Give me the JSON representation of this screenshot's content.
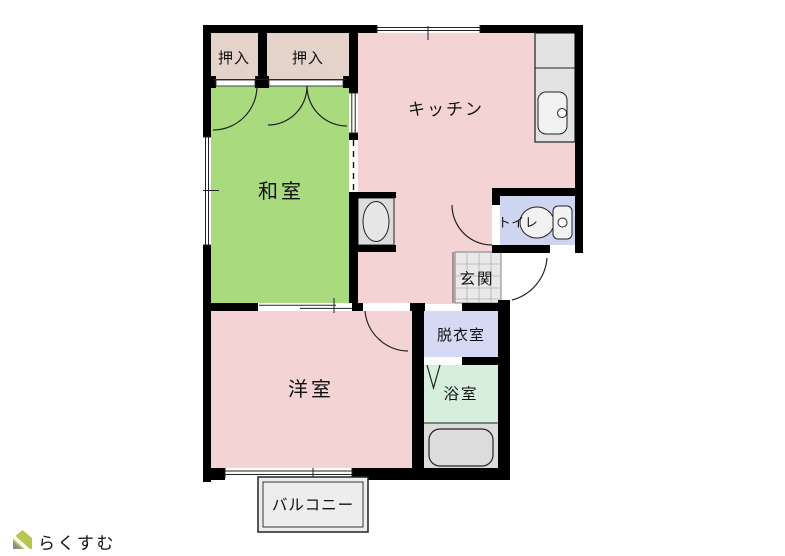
{
  "floorplan": {
    "type": "apartment-floor-plan",
    "wall_color": "#000000",
    "line_color": "#222222",
    "rooms": [
      {
        "name": "closet-left",
        "label": "押入",
        "color": "#e4d3cb"
      },
      {
        "name": "closet-right",
        "label": "押入",
        "color": "#e4d3cb"
      },
      {
        "name": "japanese-room",
        "label": "和室",
        "color": "#a9da7e"
      },
      {
        "name": "kitchen",
        "label": "キッチン",
        "color": "#f3d3d3"
      },
      {
        "name": "toilet",
        "label": "トイレ",
        "color": "#cdd5f1"
      },
      {
        "name": "entrance",
        "label": "玄関",
        "color": "#e9e9e9"
      },
      {
        "name": "dressing-room",
        "label": "脱衣室",
        "color": "#d5d9f3"
      },
      {
        "name": "western-room",
        "label": "洋室",
        "color": "#f3d3d3"
      },
      {
        "name": "bathroom",
        "label": "浴室",
        "color": "#d6efdc"
      },
      {
        "name": "balcony",
        "label": "バルコニー",
        "color": "#ededed"
      }
    ],
    "fixtures": [
      {
        "name": "kitchen-sink",
        "color": "#e3e3e3"
      },
      {
        "name": "toilet-bowl",
        "color": "#f2f2f2"
      },
      {
        "name": "bathtub",
        "color": "#dcdcdc"
      },
      {
        "name": "washbasin",
        "color": "#dcdcdc"
      }
    ]
  },
  "logo": {
    "text": "らくすむ",
    "text_color": "#b3afa9",
    "roof_color": "#b9c653",
    "body_color": "#8f8d86"
  }
}
